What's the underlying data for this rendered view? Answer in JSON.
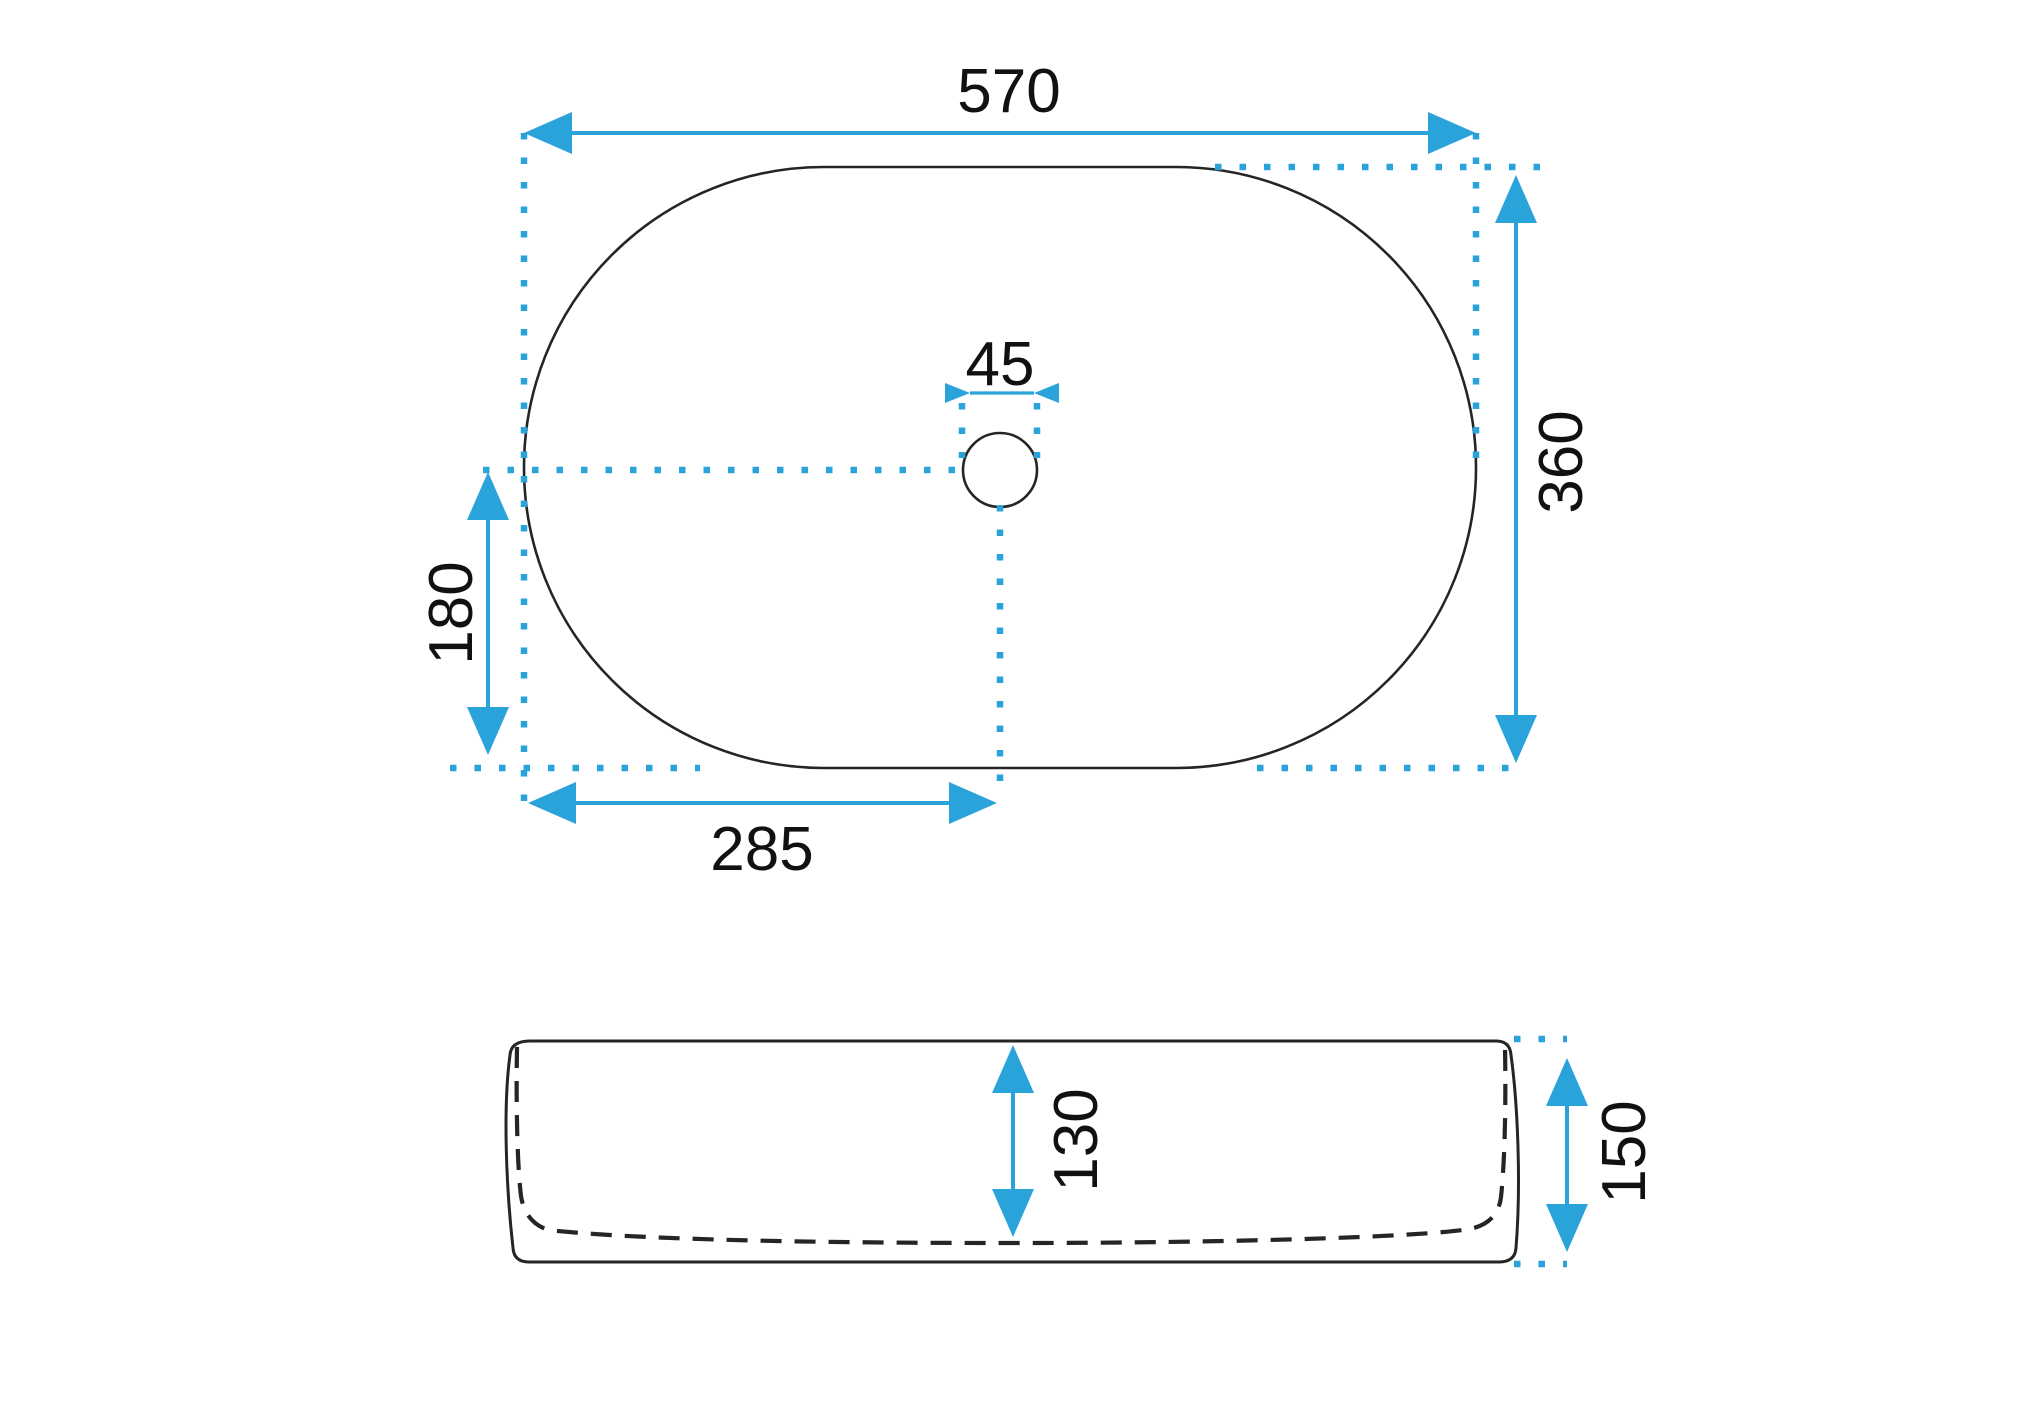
{
  "colors": {
    "dimension_accent": "#2aa3da",
    "outline": "#252525",
    "label_text": "#111111",
    "background": "#ffffff"
  },
  "drawing": {
    "type": "technical-dimension-diagram",
    "subject": "oval countertop washbasin, top view and side profile view with millimeter dimensions",
    "top_view": {
      "dimensions": {
        "overall_width": {
          "value": "570"
        },
        "overall_depth": {
          "value": "360"
        },
        "drain_hole_diameter": {
          "value": "45"
        },
        "drain_offset_vertical": {
          "value": "180"
        },
        "drain_offset_horizontal": {
          "value": "285"
        }
      }
    },
    "side_view": {
      "dimensions": {
        "inner_depth": {
          "value": "130"
        },
        "overall_height": {
          "value": "150"
        }
      }
    }
  }
}
